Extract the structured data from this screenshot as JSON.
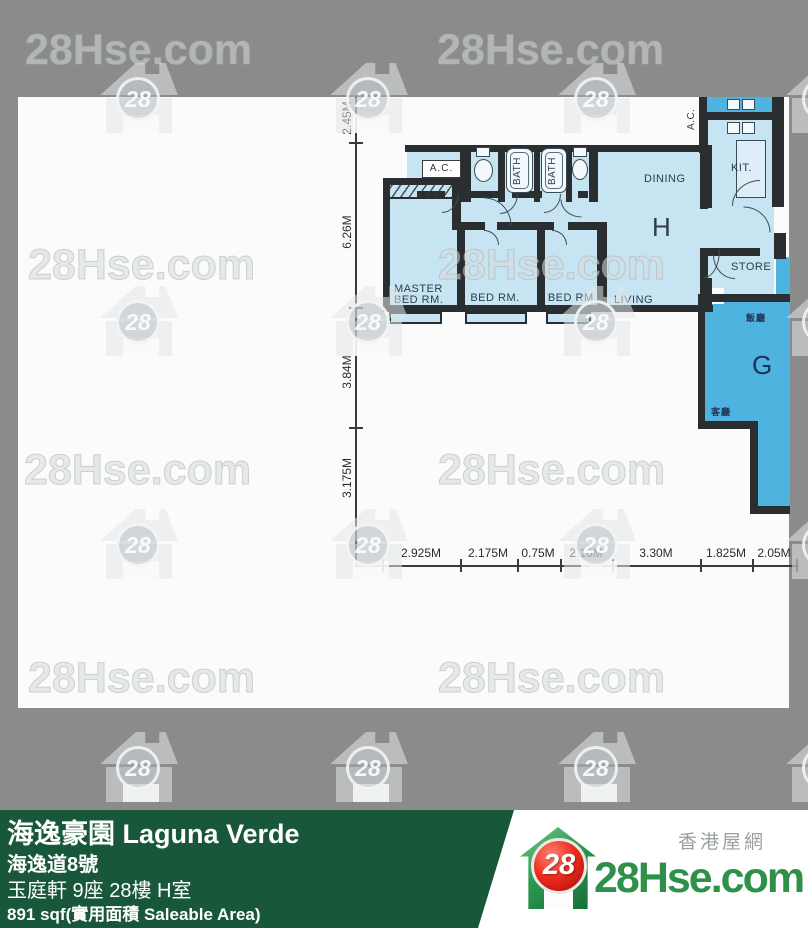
{
  "watermark": {
    "text": "28Hse.com",
    "badge": "28"
  },
  "plan": {
    "labels": {
      "ac_top": "A.C.",
      "ac_right": "A.C.",
      "master_1": "MASTER",
      "master_2": "BED RM.",
      "bed2": "BED RM.",
      "bed3": "BED RM.",
      "living": "LIVING",
      "dining": "DINING",
      "kitchen": "KIT.",
      "store": "STORE",
      "bath1": "BATH",
      "bath2": "BATH",
      "unit_h": "H",
      "unit_g": "G",
      "g_dining": "飯廳",
      "g_living": "客廳"
    },
    "dims_left": [
      "2.45M",
      "6.26M",
      "3.84M",
      "3.175M"
    ],
    "dims_bottom": [
      "2.925M",
      "2.175M",
      "0.75M",
      "2.10M",
      "3.30M",
      "1.825M",
      "2.05M"
    ]
  },
  "footer": {
    "title": "海逸豪園 Laguna Verde",
    "address": "海逸道8號",
    "unit": "玉庭軒 9座 28樓 H室",
    "area": "891 sqf(實用面積 Saleable Area)"
  },
  "logo": {
    "badge": "28",
    "site": "28Hse.com",
    "tagline": "香港屋網"
  }
}
